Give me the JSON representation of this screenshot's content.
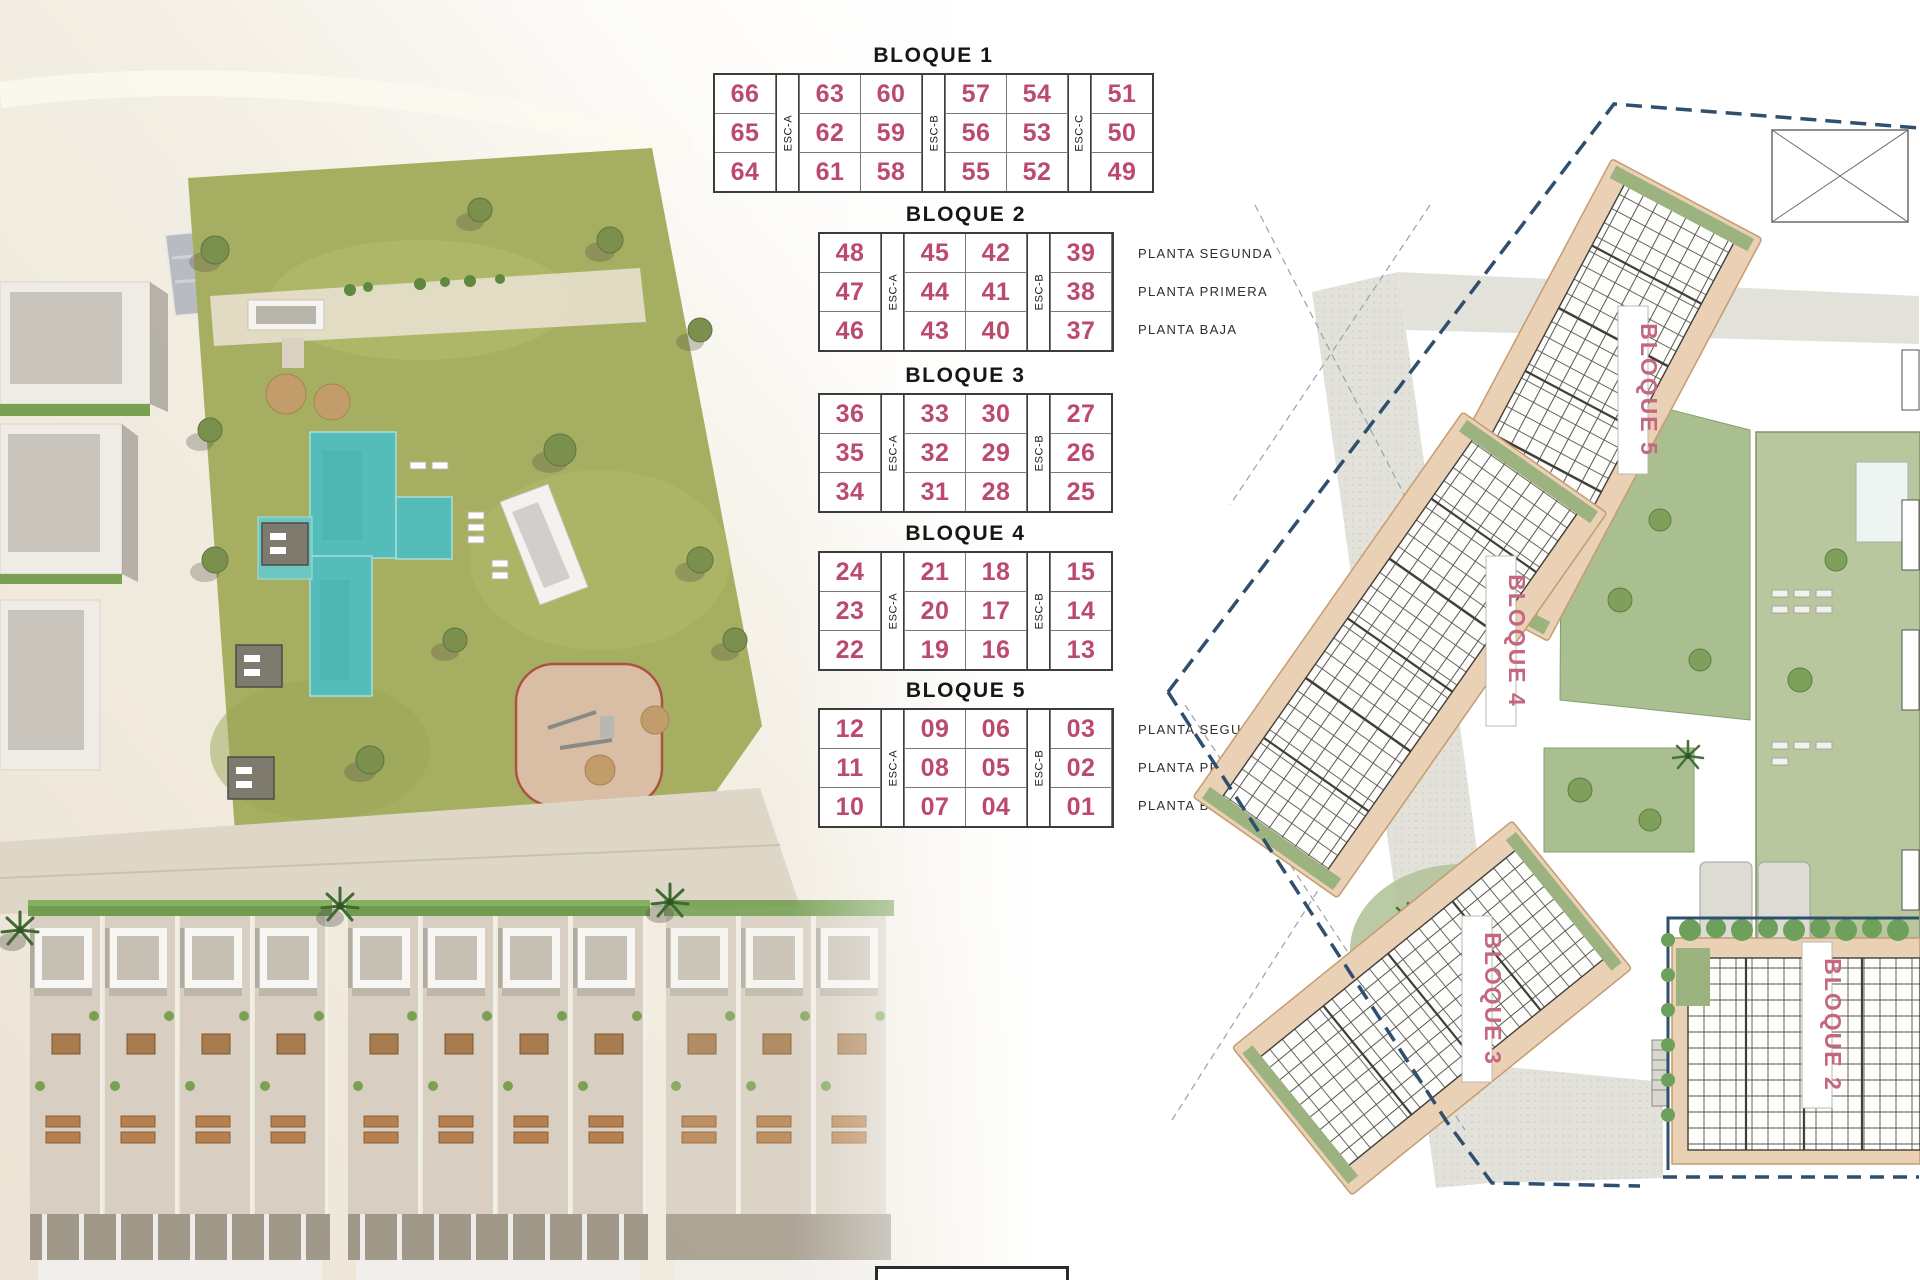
{
  "colors": {
    "unit_number": "#bc4a6d",
    "plan_label_pink": "#c4677f",
    "boundary_navy": "#2e4f6e",
    "building_tan": "#ead0b4",
    "pool_turquoise": "#55bdb9",
    "lawn_green": "#a6af61",
    "title_text": "#161616"
  },
  "blocks": [
    {
      "title": "BLOQUE 1",
      "columns": [
        {
          "type": "units",
          "values": [
            "66",
            "65",
            "64"
          ]
        },
        {
          "type": "stair",
          "label": "ESC-A"
        },
        {
          "type": "units",
          "values": [
            "63",
            "62",
            "61"
          ]
        },
        {
          "type": "units",
          "values": [
            "60",
            "59",
            "58"
          ]
        },
        {
          "type": "stair",
          "label": "ESC-B"
        },
        {
          "type": "units",
          "values": [
            "57",
            "56",
            "55"
          ]
        },
        {
          "type": "units",
          "values": [
            "54",
            "53",
            "52"
          ]
        },
        {
          "type": "stair",
          "label": "ESC-C"
        },
        {
          "type": "units",
          "values": [
            "51",
            "50",
            "49"
          ]
        }
      ]
    },
    {
      "title": "BLOQUE 2",
      "columns": [
        {
          "type": "units",
          "values": [
            "48",
            "47",
            "46"
          ]
        },
        {
          "type": "stair",
          "label": "ESC-A"
        },
        {
          "type": "units",
          "values": [
            "45",
            "44",
            "43"
          ]
        },
        {
          "type": "units",
          "values": [
            "42",
            "41",
            "40"
          ]
        },
        {
          "type": "stair",
          "label": "ESC-B"
        },
        {
          "type": "units",
          "values": [
            "39",
            "38",
            "37"
          ]
        }
      ],
      "floor_labels": [
        "PLANTA SEGUNDA",
        "PLANTA PRIMERA",
        "PLANTA BAJA"
      ]
    },
    {
      "title": "BLOQUE 3",
      "columns": [
        {
          "type": "units",
          "values": [
            "36",
            "35",
            "34"
          ]
        },
        {
          "type": "stair",
          "label": "ESC-A"
        },
        {
          "type": "units",
          "values": [
            "33",
            "32",
            "31"
          ]
        },
        {
          "type": "units",
          "values": [
            "30",
            "29",
            "28"
          ]
        },
        {
          "type": "stair",
          "label": "ESC-B"
        },
        {
          "type": "units",
          "values": [
            "27",
            "26",
            "25"
          ]
        }
      ]
    },
    {
      "title": "BLOQUE 4",
      "columns": [
        {
          "type": "units",
          "values": [
            "24",
            "23",
            "22"
          ]
        },
        {
          "type": "stair",
          "label": "ESC-A"
        },
        {
          "type": "units",
          "values": [
            "21",
            "20",
            "19"
          ]
        },
        {
          "type": "units",
          "values": [
            "18",
            "17",
            "16"
          ]
        },
        {
          "type": "stair",
          "label": "ESC-B"
        },
        {
          "type": "units",
          "values": [
            "15",
            "14",
            "13"
          ]
        }
      ]
    },
    {
      "title": "BLOQUE 5",
      "columns": [
        {
          "type": "units",
          "values": [
            "12",
            "11",
            "10"
          ]
        },
        {
          "type": "stair",
          "label": "ESC-A"
        },
        {
          "type": "units",
          "values": [
            "09",
            "08",
            "07"
          ]
        },
        {
          "type": "units",
          "values": [
            "06",
            "05",
            "04"
          ]
        },
        {
          "type": "stair",
          "label": "ESC-B"
        },
        {
          "type": "units",
          "values": [
            "03",
            "02",
            "01"
          ]
        }
      ],
      "floor_labels": [
        "PLANTA SEGUNDA",
        "PLANTA PRIMERA",
        "PLANTA BAJA"
      ]
    }
  ],
  "site_plan": {
    "building_labels": [
      {
        "text": "BLOQUE 5"
      },
      {
        "text": "BLOQUE 4"
      },
      {
        "text": "BLOQUE 3"
      },
      {
        "text": "BLOQUE 2"
      }
    ]
  }
}
